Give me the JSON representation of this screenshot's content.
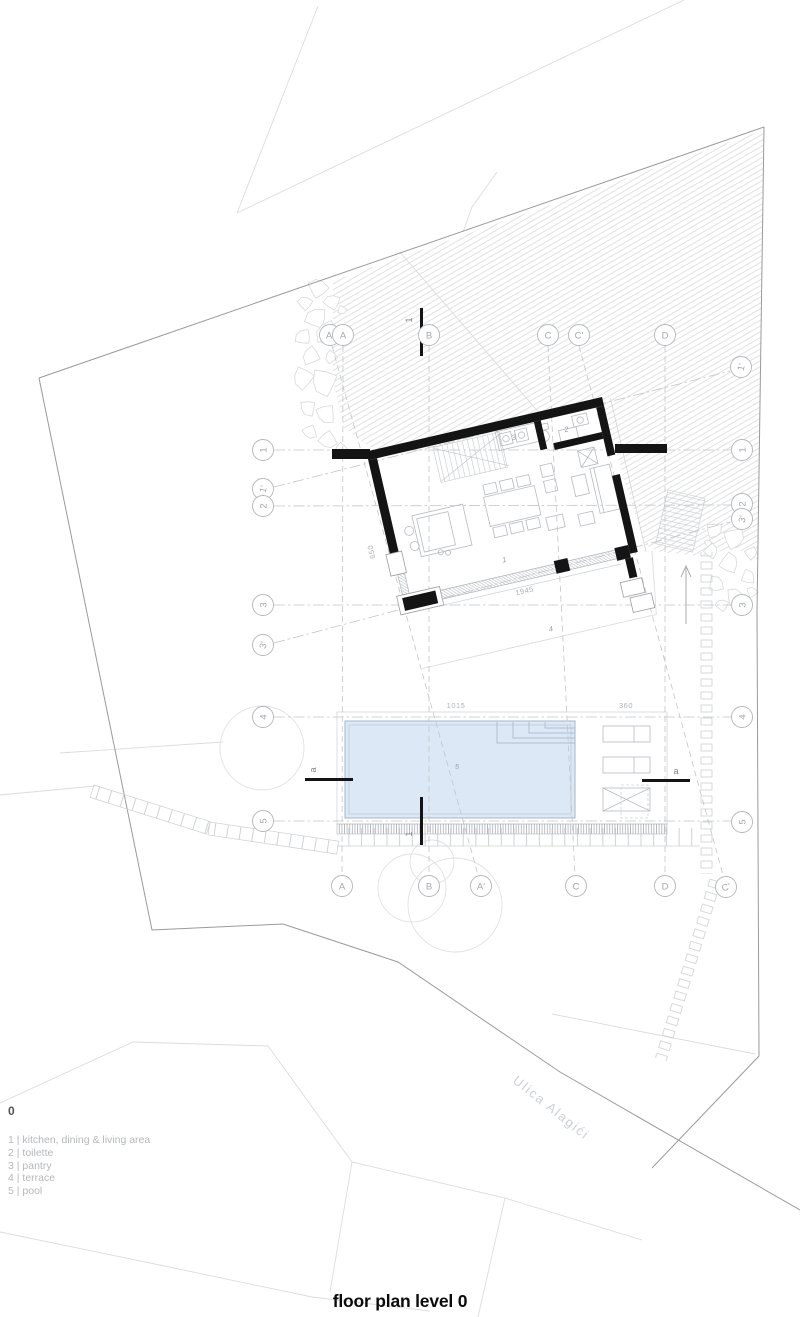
{
  "title": "floor plan level 0",
  "street_name": "Ulica Alagići",
  "legend": {
    "level_label": "0",
    "items": [
      "1 | kitchen, dining & living area",
      "2 | toilette",
      "3 | pantry",
      "4 | terrace",
      "5 | pool"
    ]
  },
  "grid": {
    "top": [
      {
        "label": "A'"
      },
      {
        "label": "A"
      },
      {
        "label": "B"
      },
      {
        "label": "C"
      },
      {
        "label": "C'"
      },
      {
        "label": "D"
      },
      {
        "label": "1'"
      }
    ],
    "left": [
      {
        "label": "1"
      },
      {
        "label": "1'"
      },
      {
        "label": "2"
      },
      {
        "label": "3"
      },
      {
        "label": "3'"
      },
      {
        "label": "4"
      },
      {
        "label": "5"
      }
    ],
    "right": [
      {
        "label": "1"
      },
      {
        "label": "2"
      },
      {
        "label": "3'"
      },
      {
        "label": "3"
      },
      {
        "label": "4"
      },
      {
        "label": "5"
      }
    ],
    "bottom": [
      {
        "label": "A"
      },
      {
        "label": "B"
      },
      {
        "label": "A'"
      },
      {
        "label": "C"
      },
      {
        "label": "D"
      },
      {
        "label": "C'"
      }
    ]
  },
  "sections": {
    "vertical_label": "1",
    "horizontal_label": "a"
  },
  "rooms": {
    "living": "1",
    "toilette": "2",
    "pantry": "3",
    "terrace": "4",
    "pool": "5"
  },
  "dimensions": {
    "west_wall": "650",
    "south_glazing": "1945",
    "pool_length": "1015",
    "deck_width": "360"
  },
  "colors": {
    "pool_fill": "#dce8f5",
    "wall": "#141414",
    "boundary": "#989a9d",
    "hatch": "#d8dadc"
  }
}
